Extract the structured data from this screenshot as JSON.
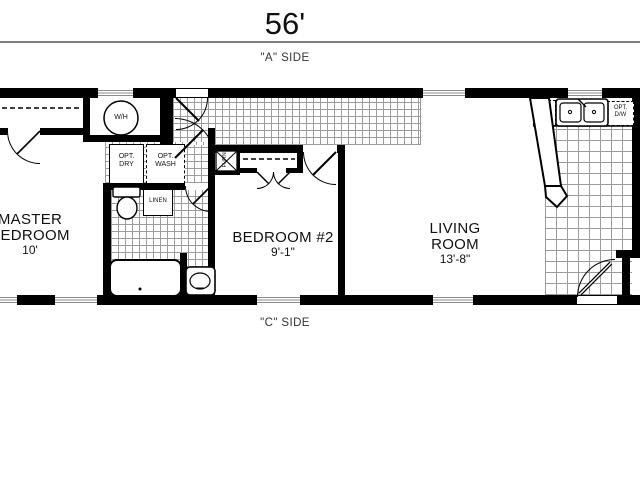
{
  "title": {
    "overall_width": "56'"
  },
  "sides": {
    "top": "\"A\" SIDE",
    "bottom": "\"C\" SIDE"
  },
  "rooms": {
    "master_bedroom": {
      "line1": "MASTER",
      "line2": "BEDROOM",
      "size": "10'"
    },
    "bedroom2": {
      "name": "BEDROOM #2",
      "size": "9'-1\""
    },
    "living_room": {
      "line1": "LIVING",
      "line2": "ROOM",
      "size": "13'-8\""
    }
  },
  "fixtures": {
    "water_heater": "W/H",
    "furnace": "FURN",
    "linen": "LINEN",
    "opt_dryer_l1": "OPT.",
    "opt_dryer_l2": "DRY",
    "opt_washer_l1": "OPT.",
    "opt_washer_l2": "WASH",
    "opt_dishwasher_l1": "OPT.",
    "opt_dishwasher_l2": "D/W"
  },
  "colors": {
    "wall": "#000000",
    "tile_line": "#9c9c9c",
    "window_stripe": "#8a8a8a",
    "dimension_line": "#7d7d7d",
    "text": "#111111"
  }
}
